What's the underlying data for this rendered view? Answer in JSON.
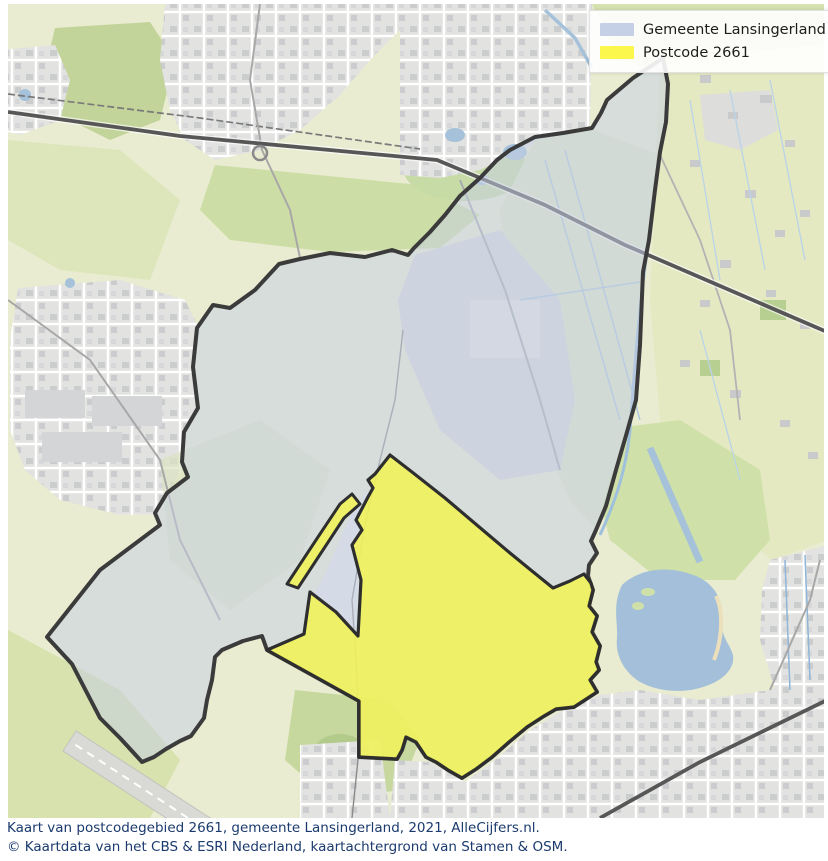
{
  "legend": {
    "items": [
      {
        "label": "Gemeente Lansingerland"
      },
      {
        "label": "Postcode 2661"
      }
    ]
  },
  "caption": {
    "line1": "Kaart van postcodegebied 2661, gemeente Lansingerland, 2021, AlleCijfers.nl.",
    "line2": "© Kaartdata van het CBS & ESRI Nederland, kaartachtergrond van Stamen & OSM."
  },
  "colors": {
    "municipality_fill": "#c6d0e4",
    "municipality_swatch": "#c5d0e6",
    "postcode_fill": "#f1f257",
    "postcode_swatch": "#fcf74d",
    "boundary_stroke": "#3b3b3b",
    "postcode_stroke": "#2e2e2e",
    "water": "#a3bfd9",
    "field_green": "#e9ecd0",
    "park_green": "#c6d89e",
    "urban_gray": "#e0e0de",
    "caption_text": "#1b3a6e",
    "legend_bg": "rgba(255,255,255,0.90)"
  }
}
